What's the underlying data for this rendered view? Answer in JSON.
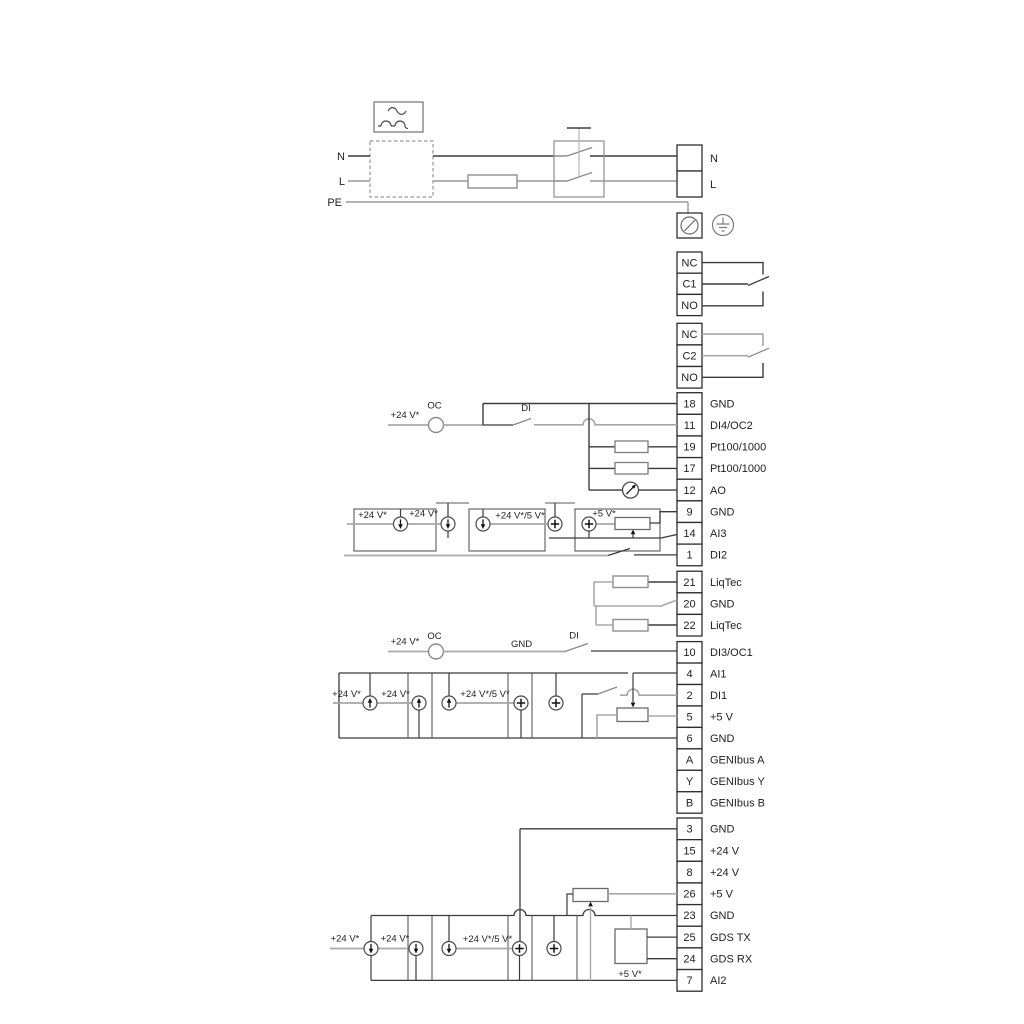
{
  "power": {
    "n_in": "N",
    "l_in": "L",
    "pe": "PE",
    "n_out": "N",
    "l_out": "L"
  },
  "relays": {
    "relay1": {
      "rows": [
        "NC",
        "C1",
        "NO"
      ]
    },
    "relay2": {
      "rows": [
        "NC",
        "C2",
        "NO"
      ]
    }
  },
  "terminals": {
    "io1": {
      "rows": [
        {
          "id": "18",
          "label": "GND"
        },
        {
          "id": "11",
          "label": "DI4/OC2"
        },
        {
          "id": "19",
          "label": "Pt100/1000"
        },
        {
          "id": "17",
          "label": "Pt100/1000"
        },
        {
          "id": "12",
          "label": "AO"
        },
        {
          "id": "9",
          "label": "GND"
        },
        {
          "id": "14",
          "label": "AI3"
        },
        {
          "id": "1",
          "label": "DI2"
        }
      ]
    },
    "liqtec": {
      "rows": [
        {
          "id": "21",
          "label": "LiqTec"
        },
        {
          "id": "20",
          "label": "GND"
        },
        {
          "id": "22",
          "label": "LiqTec"
        }
      ]
    },
    "io2": {
      "rows": [
        {
          "id": "10",
          "label": "DI3/OC1"
        },
        {
          "id": "4",
          "label": "AI1"
        },
        {
          "id": "2",
          "label": "DI1"
        },
        {
          "id": "5",
          "label": "+5 V"
        },
        {
          "id": "6",
          "label": "GND"
        },
        {
          "id": "A",
          "label": "GENIbus A"
        },
        {
          "id": "Y",
          "label": "GENIbus Y"
        },
        {
          "id": "B",
          "label": "GENIbus B"
        }
      ]
    },
    "io3": {
      "rows": [
        {
          "id": "3",
          "label": "GND"
        },
        {
          "id": "15",
          "label": "+24 V"
        },
        {
          "id": "8",
          "label": "+24 V"
        },
        {
          "id": "26",
          "label": "+5 V"
        },
        {
          "id": "23",
          "label": "GND"
        },
        {
          "id": "25",
          "label": "GDS TX"
        },
        {
          "id": "24",
          "label": "GDS RX"
        },
        {
          "id": "7",
          "label": "AI2"
        }
      ]
    }
  },
  "inline_labels": {
    "v24": "+24 V*",
    "v24_5": "+24 V*/5 V*",
    "v5": "+5 V*",
    "oc": "OC",
    "di": "DI",
    "gnd": "GND"
  },
  "colors": {
    "wire_dark": "#3b3b3b",
    "wire_gray": "#a8a8a8",
    "terminal_stroke": "#2e2e2e",
    "component_stroke": "#8f8f8f"
  }
}
